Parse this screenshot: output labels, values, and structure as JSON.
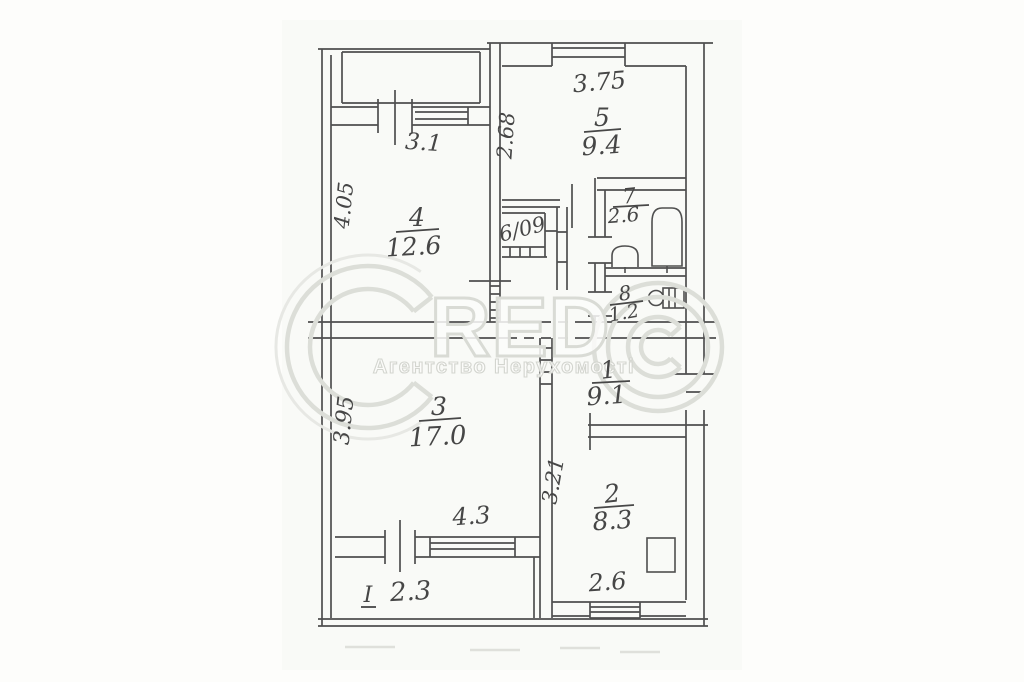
{
  "watermark": {
    "brand_letters": "RED",
    "subtitle": "Агентство Нерухомості"
  },
  "rooms": {
    "r1": {
      "number": "1",
      "area": "9.1"
    },
    "r2": {
      "number": "2",
      "area": "8.3"
    },
    "r3": {
      "number": "3",
      "area": "17.0"
    },
    "r4": {
      "number": "4",
      "area": "12.6"
    },
    "r5": {
      "number": "5",
      "area": "9.4"
    },
    "r6": {
      "label": "6/09"
    },
    "r7": {
      "number": "7",
      "area": "2.6"
    },
    "r8": {
      "number": "8",
      "area": "1.2"
    }
  },
  "dimensions": {
    "room4_top": "3.1",
    "room4_left": "4.05",
    "room5_top": "3.75",
    "room5_left": "2.68",
    "room3_left": "3.95",
    "room3_bottom": "4.3",
    "balcony_mark": "I",
    "balcony_value": "2.3",
    "room2_left": "3.21",
    "room2_bottom": "2.6"
  }
}
